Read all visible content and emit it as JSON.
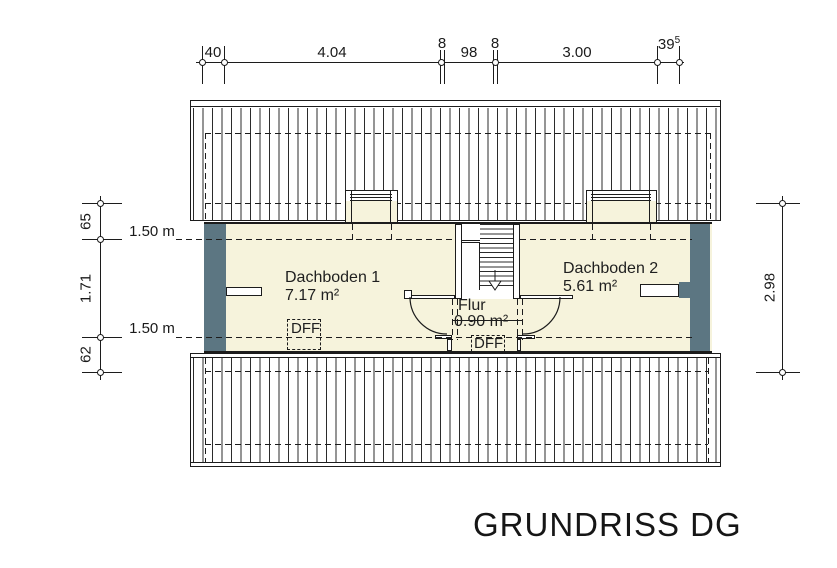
{
  "title": "GRUNDRISS DG",
  "colors": {
    "room_fill": "#f6f3dc",
    "wall_fill": "#5c7682",
    "line": "#1c1c1c"
  },
  "dim_top": {
    "d1": "40",
    "d2": "4.04",
    "d3": "8",
    "d4": "98",
    "d5": "8",
    "d6": "3.00",
    "d7": "39",
    "d7sup": "5"
  },
  "dim_left": {
    "d1": "65",
    "d2": "1.71",
    "d3": "62",
    "h1": "1.50 m",
    "h2": "1.50 m"
  },
  "dim_right": {
    "d1": "2.98"
  },
  "rooms": {
    "r1_name": "Dachboden 1",
    "r1_area": "7.17 m²",
    "r2_name": "Dachboden 2",
    "r2_area": "5.61 m²",
    "r3_name": "Flur",
    "r3_area": "0.90 m²"
  },
  "roof_windows": {
    "dff1": "DFF",
    "dff2": "DFF"
  }
}
